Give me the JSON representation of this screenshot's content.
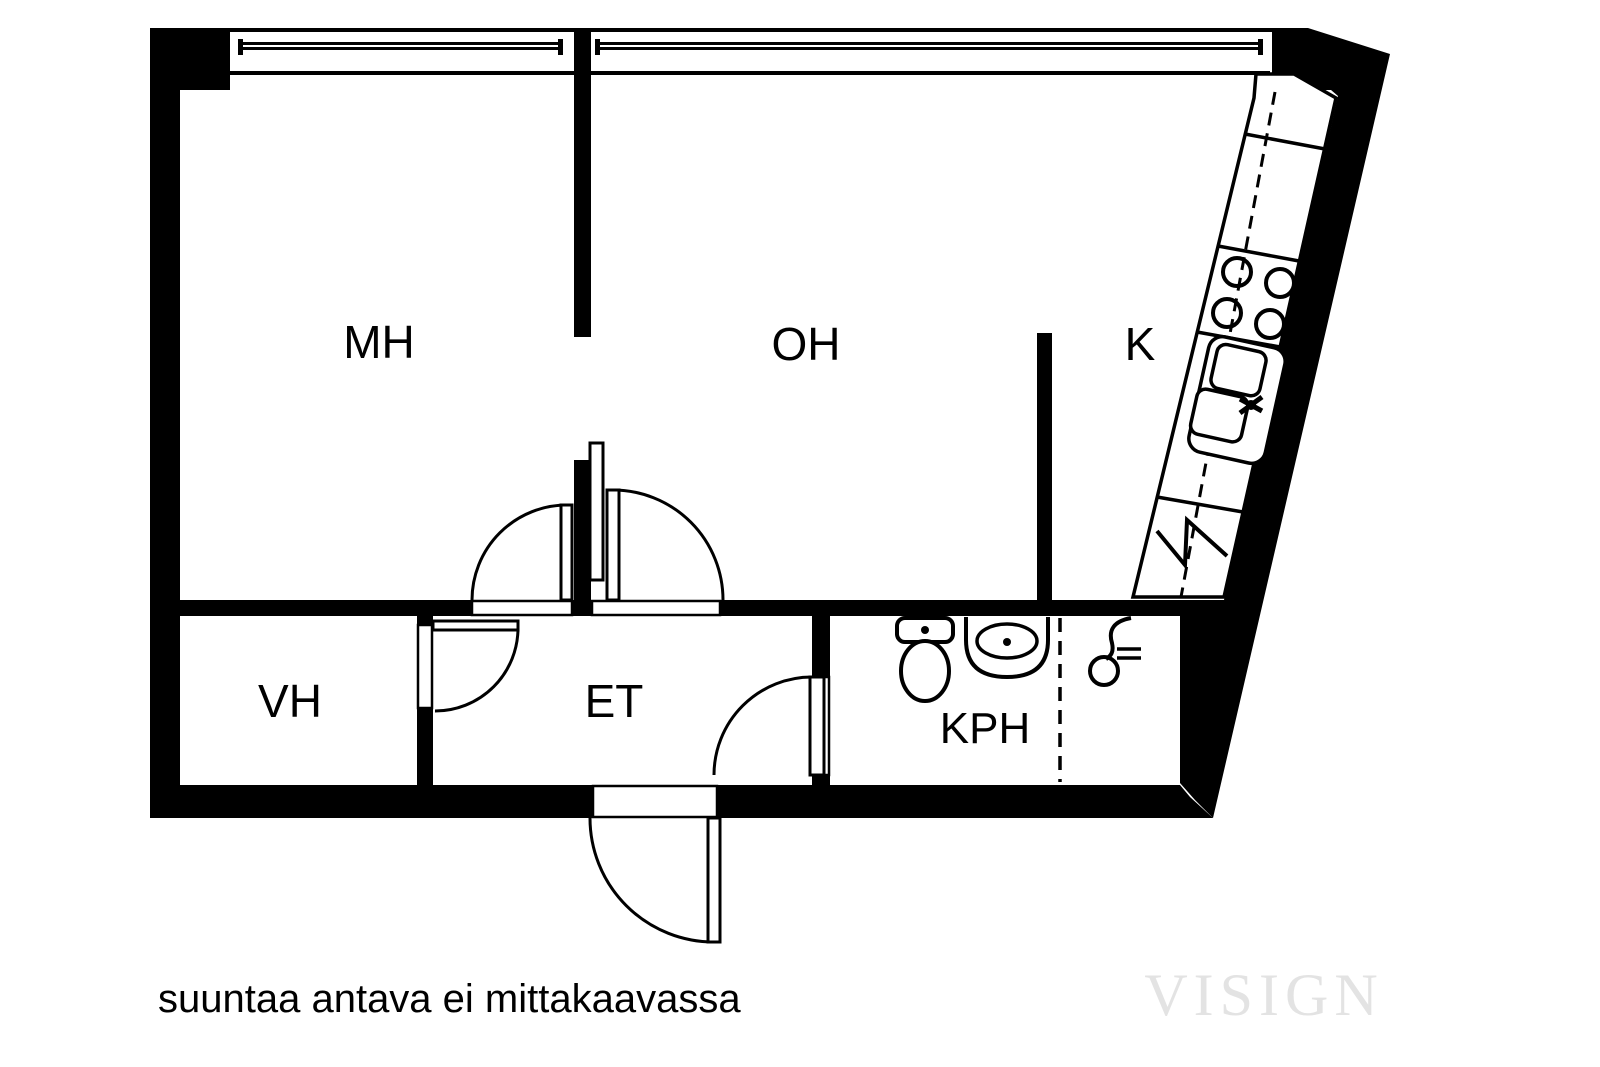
{
  "plan": {
    "note": "suuntaa antava ei mittakaavassa",
    "watermark": "VISIGN",
    "rooms": {
      "bedroom": {
        "label": "MH"
      },
      "living": {
        "label": "OH"
      },
      "kitchen": {
        "label": "K"
      },
      "closet": {
        "label": "VH"
      },
      "hall": {
        "label": "ET"
      },
      "bathroom": {
        "label": "KPH"
      }
    },
    "colors": {
      "wall": "#000000",
      "floor": "#ffffff",
      "watermark": "#e3e3e3"
    }
  }
}
